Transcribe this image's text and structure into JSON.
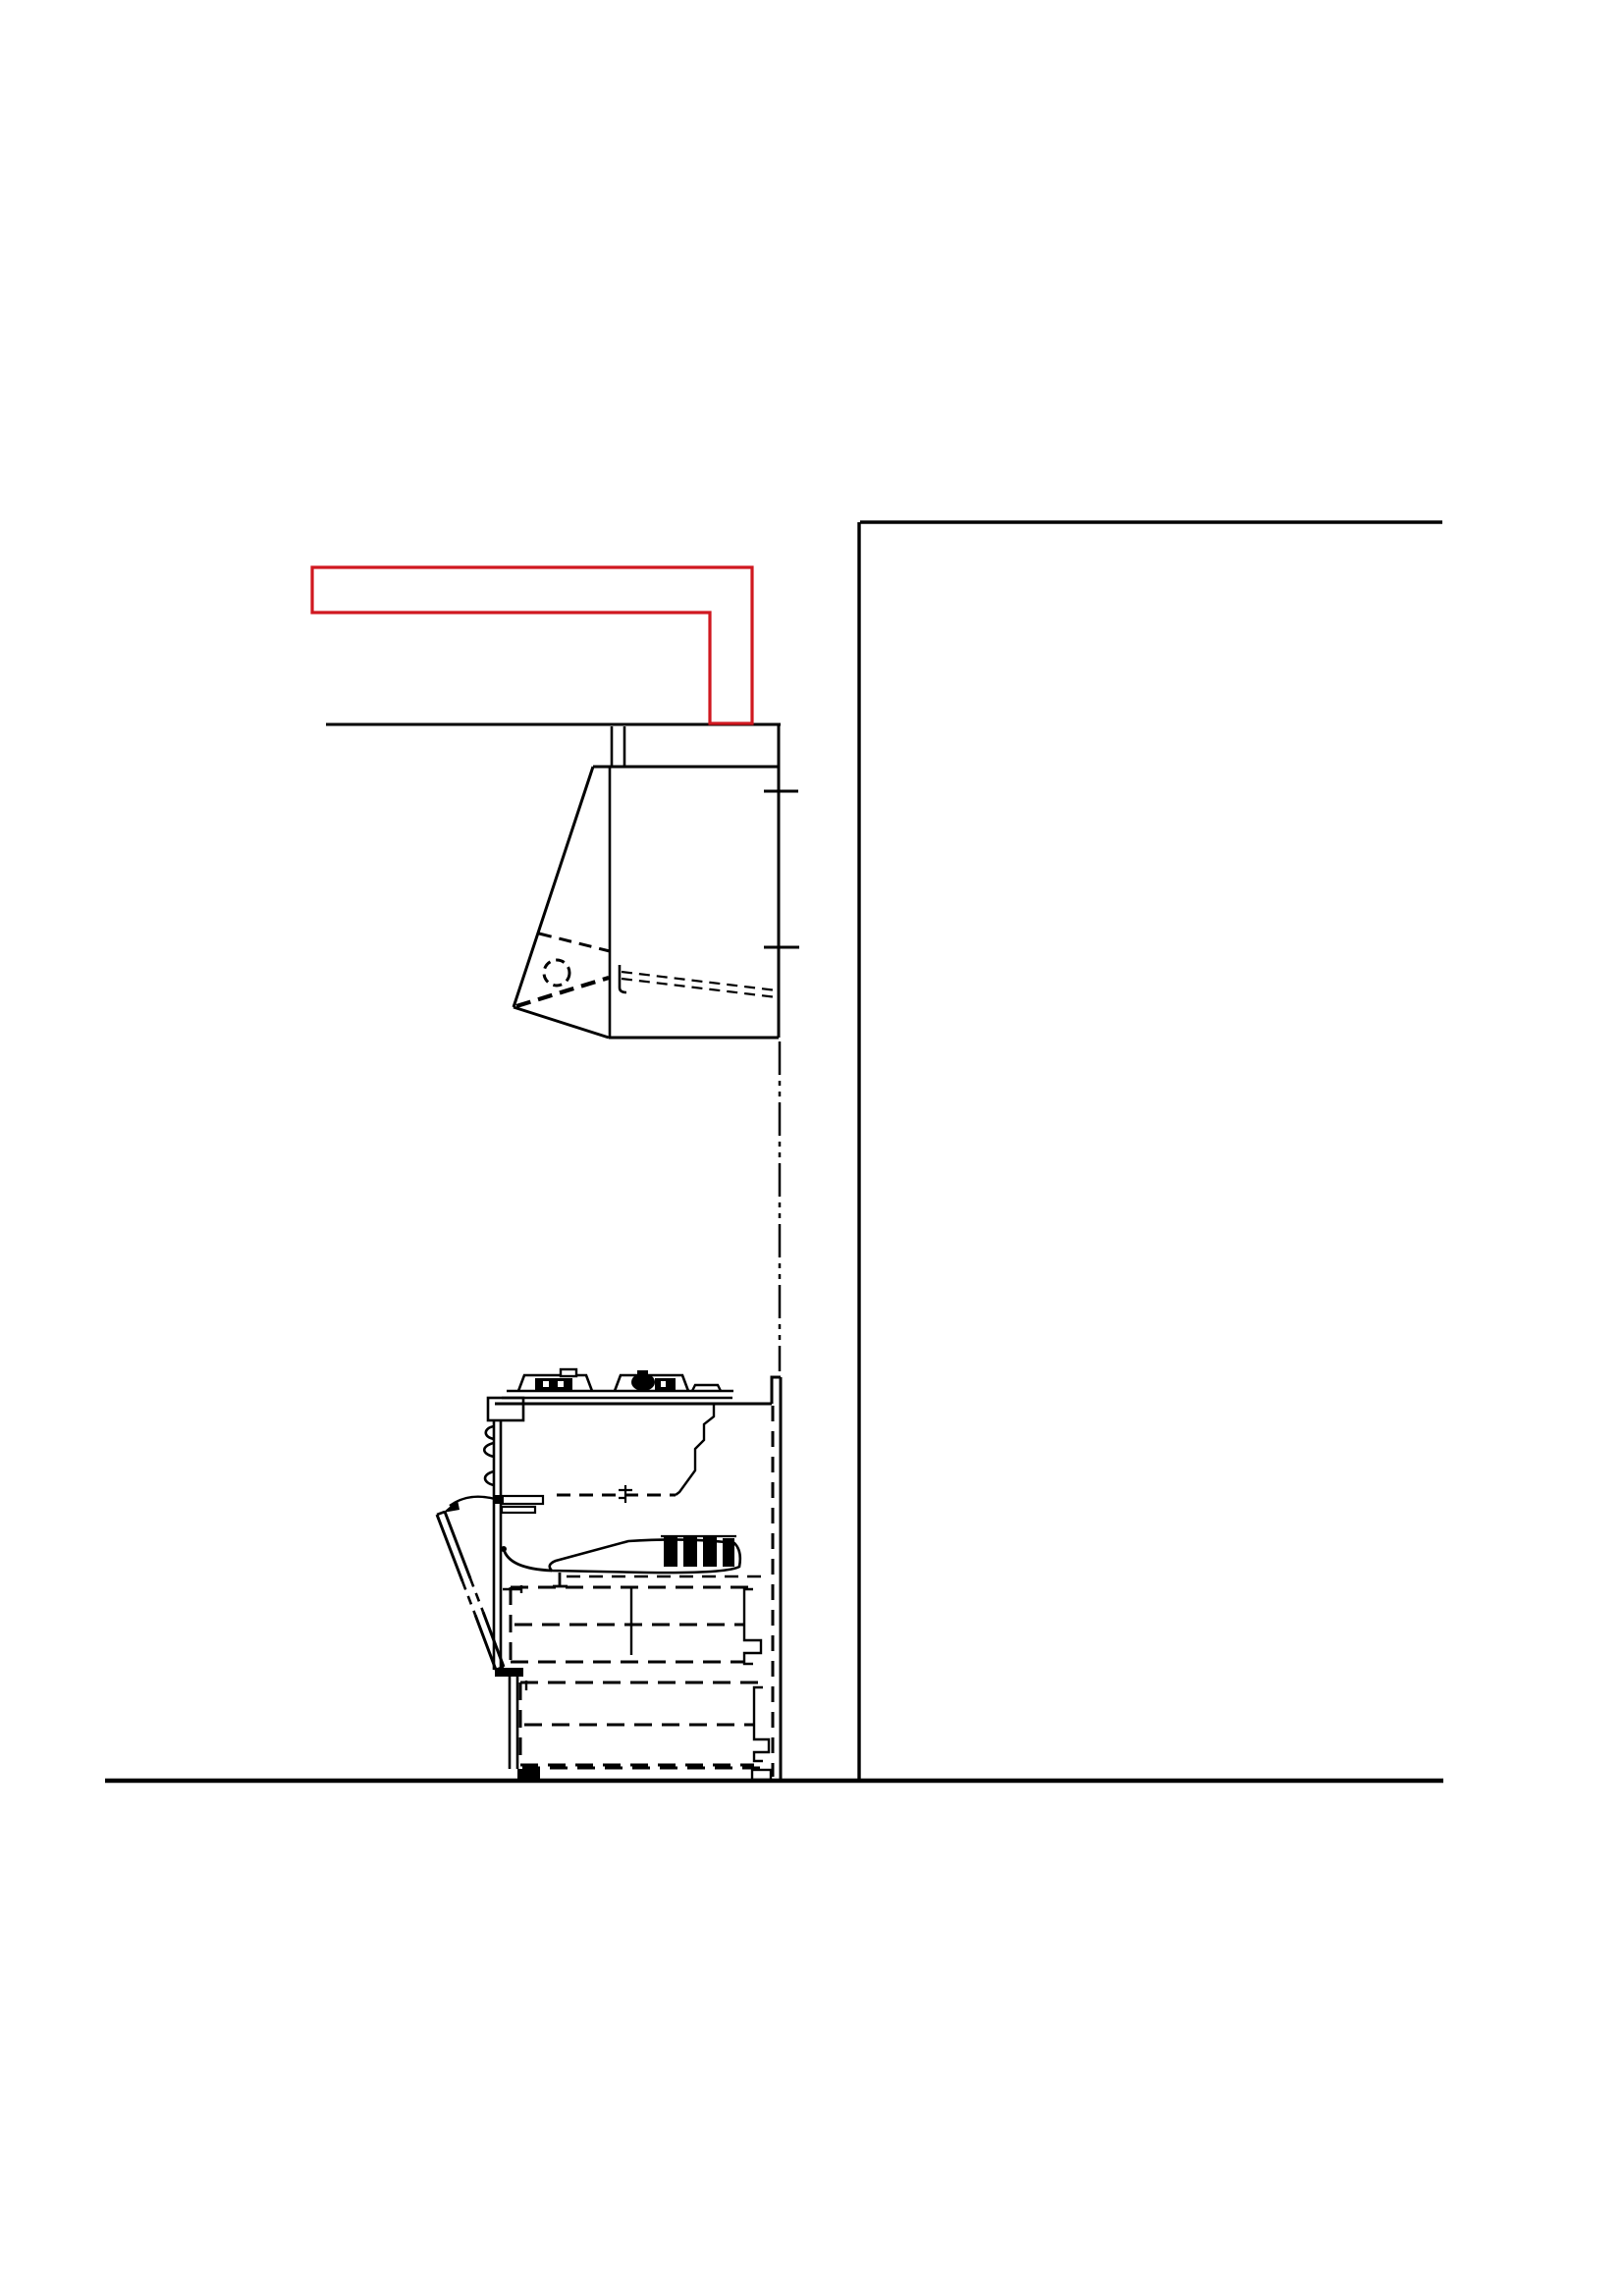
{
  "drawing": {
    "background": "#ffffff",
    "line_color": "#000000",
    "duct_fill": "#ff9a9a",
    "duct_stroke": "#d01820"
  }
}
